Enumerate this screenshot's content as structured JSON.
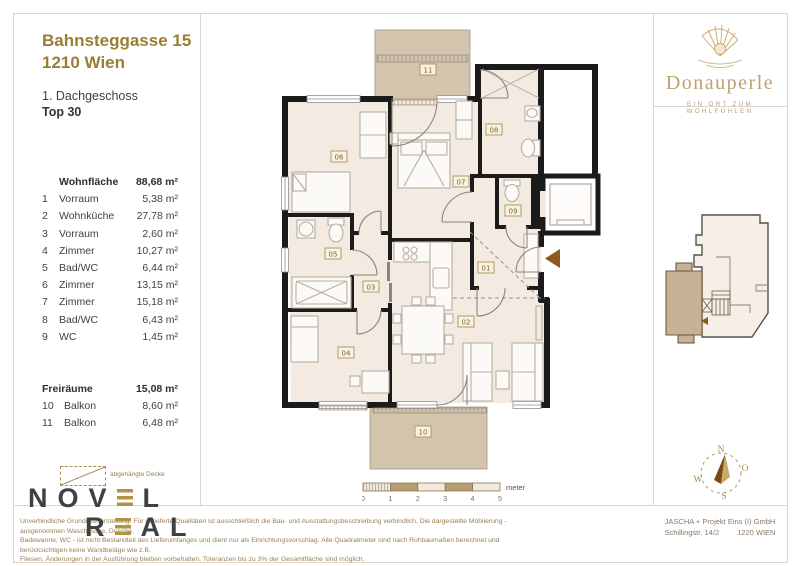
{
  "header": {
    "address1": "Bahnsteggasse 15",
    "address2": "1210 Wien",
    "floor": "1. Dachgeschoss",
    "unit": "Top 30"
  },
  "brand": {
    "name": "Donauperle",
    "tagline": "EIN ORT ZUM WOHLFÜHLEN"
  },
  "areas": {
    "living": {
      "label": "Wohnfläche",
      "total": "88,68 m²",
      "rooms": [
        {
          "nr": "1",
          "name": "Vorraum",
          "area": "5,38 m²"
        },
        {
          "nr": "2",
          "name": "Wohnküche",
          "area": "27,78 m²"
        },
        {
          "nr": "3",
          "name": "Vorraum",
          "area": "2,60 m²"
        },
        {
          "nr": "4",
          "name": "Zimmer",
          "area": "10,27 m²"
        },
        {
          "nr": "5",
          "name": "Bad/WC",
          "area": "6,44 m²"
        },
        {
          "nr": "6",
          "name": "Zimmer",
          "area": "13,15 m²"
        },
        {
          "nr": "7",
          "name": "Zimmer",
          "area": "15,18 m²"
        },
        {
          "nr": "8",
          "name": "Bad/WC",
          "area": "6,43 m²"
        },
        {
          "nr": "9",
          "name": "WC",
          "area": "1,45 m²"
        }
      ]
    },
    "open": {
      "label": "Freiräume",
      "total": "15,08 m²",
      "rooms": [
        {
          "nr": "10",
          "name": "Balkon",
          "area": "8,60 m²"
        },
        {
          "nr": "11",
          "name": "Balkon",
          "area": "6,48 m²"
        }
      ]
    }
  },
  "legend": {
    "suspended_ceiling": "abgehängte Decke"
  },
  "plan": {
    "labels": [
      "01",
      "02",
      "03",
      "04",
      "05",
      "06",
      "07",
      "08",
      "09",
      "10",
      "11"
    ]
  },
  "scalebar": {
    "ticks": [
      "0",
      "1",
      "2",
      "3",
      "4",
      "5"
    ],
    "unit": "meter"
  },
  "compass": {
    "n": "N",
    "e": "O",
    "s": "S",
    "w": "W"
  },
  "logo": {
    "part1": "NOV",
    "part2": "L",
    "part3": "R",
    "part4": "AL"
  },
  "footer": {
    "disclaimer1": "Unverbindliche Grundrissdarstellung. Für gelieferte Qualitäten ist ausschließlich die Bau- und Ausstattungsbeschreibung verbindlich. Die dargestellte Möblierung - ausgenommen Waschtische, Dusche,",
    "disclaimer2": "Badewanne, WC - ist nicht Bestandteil des Lieferumfanges und dient nur als Einrichtungsvorschlag. Alle Quadratmeter sind nach Rohbaumaßen berechnet und berücksichtigen keine Wandbeläge wie z.B.",
    "disclaimer3": "Fliesen. Änderungen in der Ausführung bleiben vorbehalten. Toleranzen bis zu 3% der Gesamtfläche sind möglich.",
    "company": "JASCHA + Projekt Eins (I) GmbH",
    "street": "Schillingstr. 14/2",
    "city": "1220 WIEN"
  },
  "colors": {
    "gold": "#9a7e33",
    "brand_gold": "#bda172",
    "wall": "#1b1b1b",
    "floor_fill": "#f3eae2",
    "balcony_fill": "#d3c4ae",
    "label_brown": "#7d6428"
  }
}
